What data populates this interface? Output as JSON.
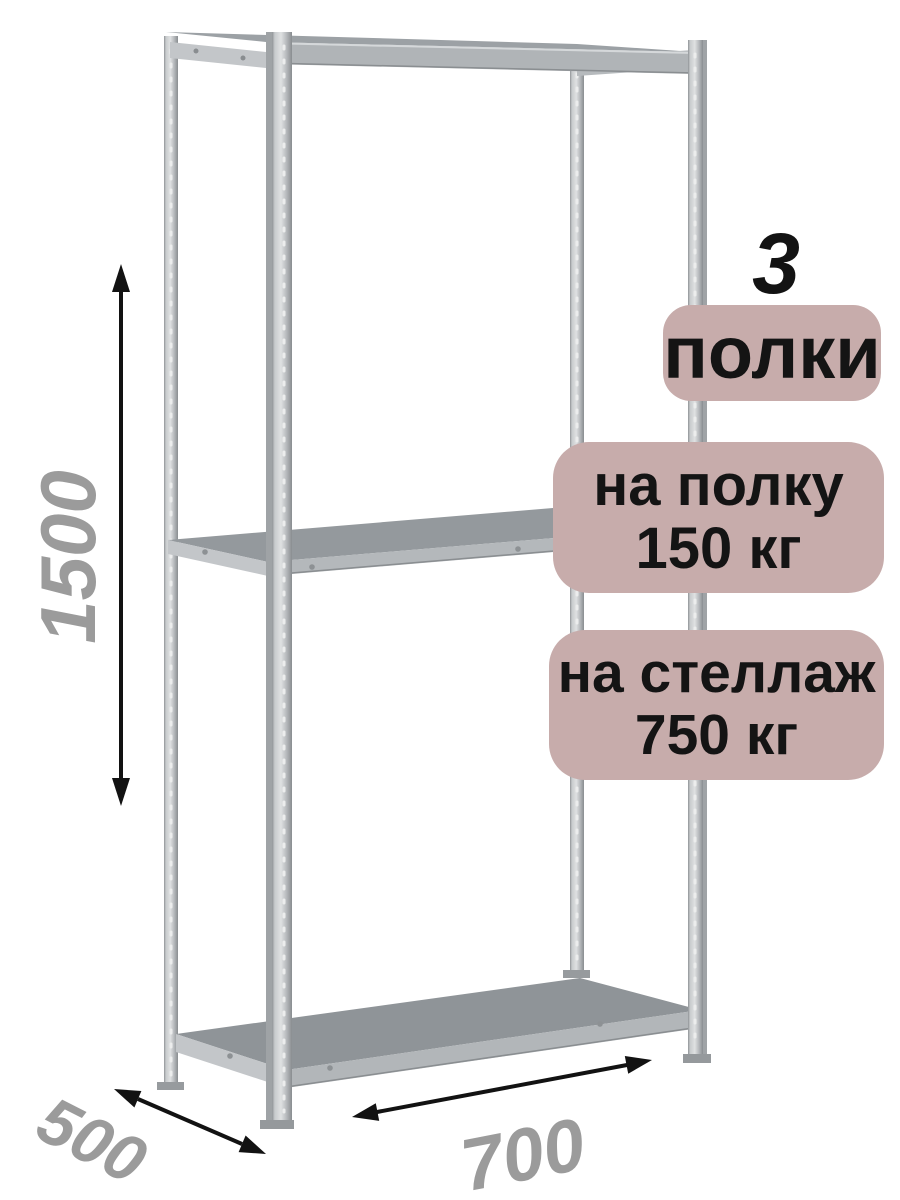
{
  "annotations": {
    "shelf_count": {
      "number": "3",
      "label": "полки"
    },
    "per_shelf": {
      "line1": "на полку",
      "line2": "150 кг"
    },
    "per_rack": {
      "line1": "на стеллаж",
      "line2": "750 кг"
    },
    "dim_height": "1500",
    "dim_depth": "500",
    "dim_width": "700"
  },
  "colors": {
    "background": "#ffffff",
    "badge_bg": "#c7acab",
    "badge_text": "#141414",
    "dimension_text": "#9b9b9b",
    "arrow": "#121212",
    "metal_light": "#dfe1e2",
    "metal_mid": "#9ca1a5",
    "metal_dark": "#8a8e91",
    "shelf_top": "#90959a",
    "shelf_edge": "#b3b7ba"
  }
}
